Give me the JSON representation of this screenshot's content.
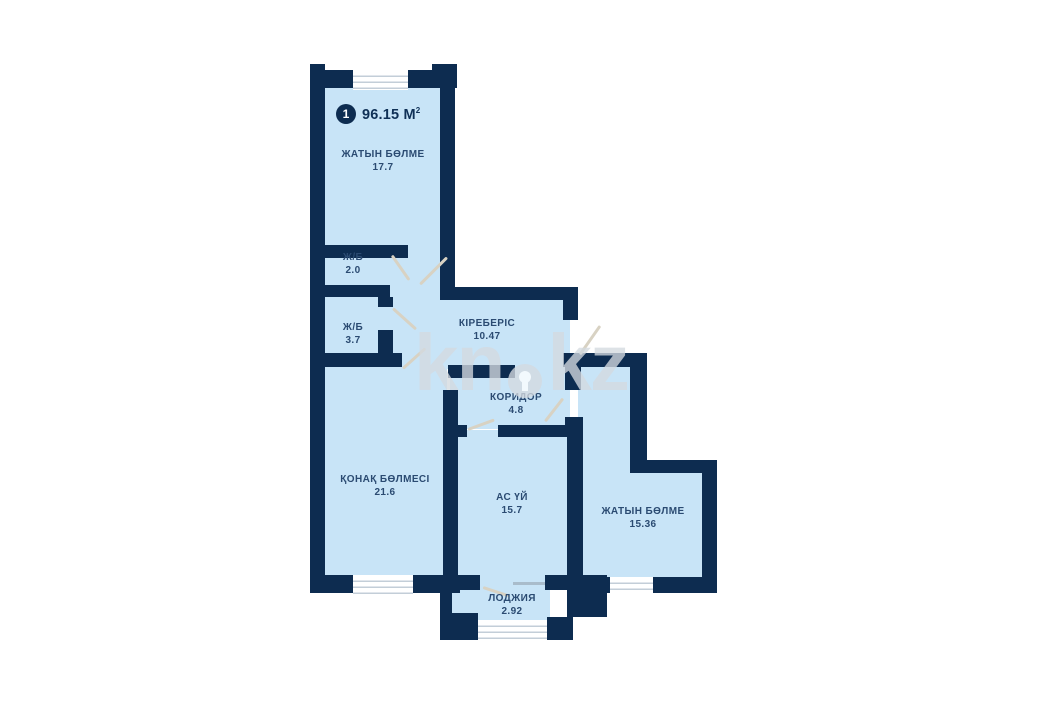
{
  "unit": {
    "badge_number": "1",
    "total_area": "96.15 М",
    "area_superscript": "2"
  },
  "watermark": {
    "left": "kn",
    "right": "kz"
  },
  "rooms": [
    {
      "id": "bedroom-top",
      "label": "ЖАТЫН БӨЛМЕ",
      "area": "17.7"
    },
    {
      "id": "bathroom-small",
      "label": "Ж/Б",
      "area": "2.0"
    },
    {
      "id": "bathroom",
      "label": "Ж/Б",
      "area": "3.7"
    },
    {
      "id": "entrance-hall",
      "label": "КІРЕБЕРІС",
      "area": "10.47"
    },
    {
      "id": "corridor",
      "label": "КОРИДОР",
      "area": "4.8"
    },
    {
      "id": "living-room",
      "label": "ҚОНАҚ БӨЛМЕСІ",
      "area": "21.6"
    },
    {
      "id": "kitchen",
      "label": "АС ҮЙ",
      "area": "15.7"
    },
    {
      "id": "bedroom-right",
      "label": "ЖАТЫН БӨЛМЕ",
      "area": "15.36"
    },
    {
      "id": "loggia",
      "label": "ЛОДЖИЯ",
      "area": "2.92"
    }
  ],
  "colors": {
    "wall": "#0d2c50",
    "room_fill": "#c8e4f7",
    "label_text": "#2b4b72",
    "title_text": "#0f3056",
    "door_line": "#d8d2c3",
    "window_stripe": "#c3ced8",
    "watermark": "#d4dae0"
  }
}
